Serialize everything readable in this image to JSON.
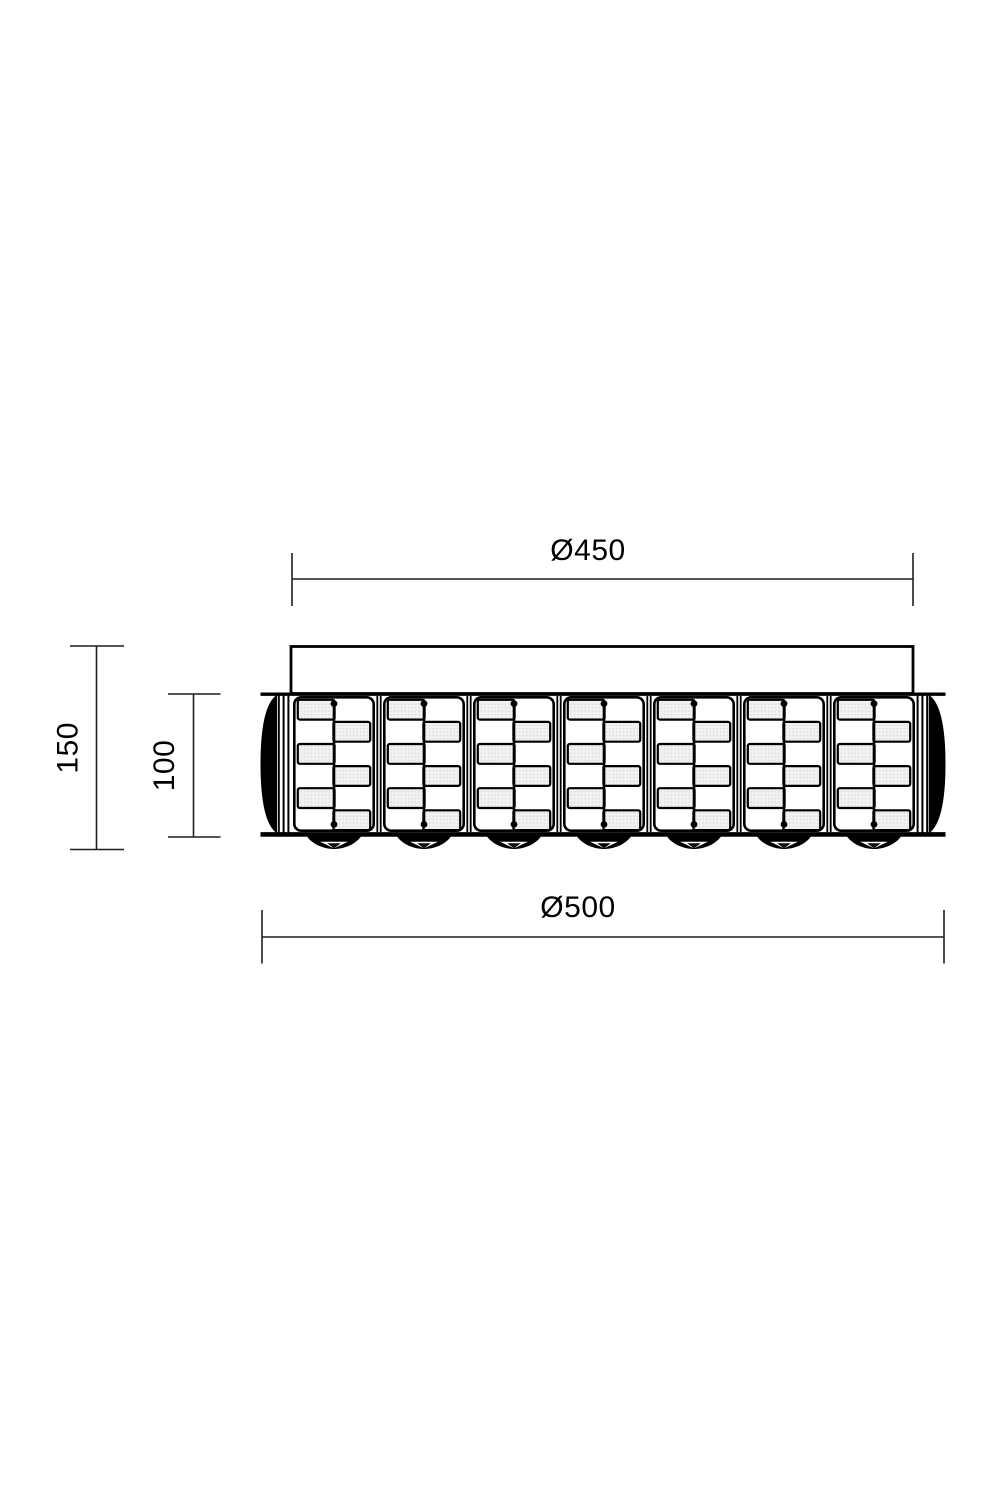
{
  "drawing": {
    "type": "technical-dimension-drawing",
    "view": "side-elevation",
    "dimensions": {
      "canopy_diameter": "Ø450",
      "body_diameter": "Ø500",
      "overall_height": "150",
      "body_height": "100"
    },
    "panel_count": 7,
    "finial_count": 7,
    "colors": {
      "line": "#000000",
      "dimension_line": "#1f1f1f",
      "text": "#000000",
      "panel_fill": "#f1f1f1",
      "background": "#ffffff"
    }
  }
}
